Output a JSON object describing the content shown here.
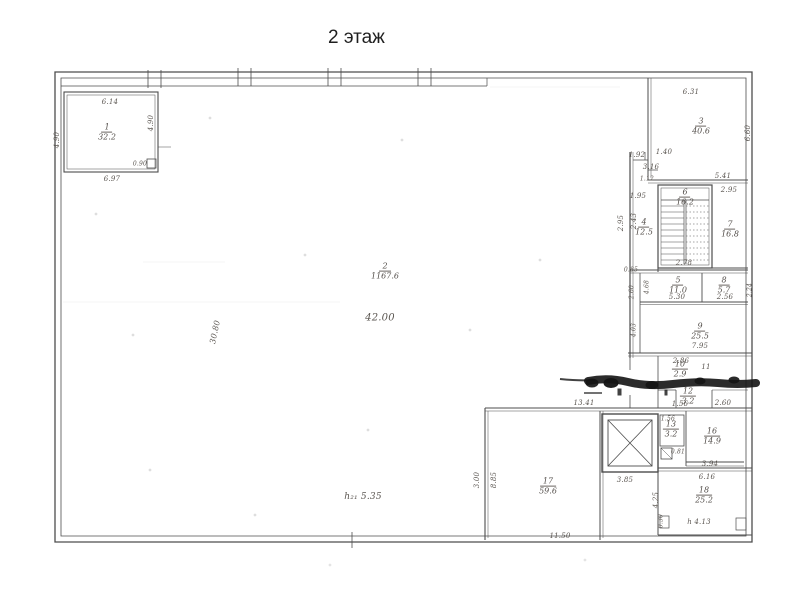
{
  "title": "2 этаж",
  "colors": {
    "paper": "#ffffff",
    "ink": "#4d4d4d",
    "pencil": "#5a5550",
    "smudge": "#141414"
  },
  "plan": {
    "rooms": [
      {
        "number": "1",
        "area": "32.2",
        "x": 107,
        "y": 133
      },
      {
        "number": "2",
        "area": "1167.6",
        "x": 385,
        "y": 272
      },
      {
        "number": "3",
        "area": "40.6",
        "x": 701,
        "y": 127
      },
      {
        "number": "4",
        "area": "12.5",
        "x": 644,
        "y": 228
      },
      {
        "number": "6",
        "area": "16.2",
        "x": 685,
        "y": 198
      },
      {
        "number": "7",
        "area": "16.8",
        "x": 730,
        "y": 230
      },
      {
        "number": "5",
        "area": "11.0",
        "x": 678,
        "y": 286
      },
      {
        "number": "8",
        "area": "5.7",
        "x": 724,
        "y": 286
      },
      {
        "number": "9",
        "area": "25.5",
        "x": 700,
        "y": 332
      },
      {
        "number": "10",
        "area": "2.9",
        "x": 680,
        "y": 370
      },
      {
        "number": "12",
        "area": "3.2",
        "x": 688,
        "y": 397
      },
      {
        "number": "13",
        "area": "3.2",
        "x": 671,
        "y": 430
      },
      {
        "number": "16",
        "area": "14.9",
        "x": 712,
        "y": 437
      },
      {
        "number": "17",
        "area": "59.6",
        "x": 548,
        "y": 487
      },
      {
        "number": "18",
        "area": "25.2",
        "x": 704,
        "y": 496
      }
    ],
    "dimensions": [
      {
        "text": "6.14",
        "x": 110,
        "y": 102
      },
      {
        "text": "6.97",
        "x": 112,
        "y": 179
      },
      {
        "text": "4.90",
        "x": 151,
        "y": 123,
        "rot": -90
      },
      {
        "text": "4.90",
        "x": 57,
        "y": 140,
        "rot": -90
      },
      {
        "text": "0.90",
        "x": 140,
        "y": 164,
        "s": 6
      },
      {
        "text": "6.31",
        "x": 691,
        "y": 92
      },
      {
        "text": "6.60",
        "x": 748,
        "y": 133,
        "rot": -90
      },
      {
        "text": "1.92",
        "x": 637,
        "y": 155
      },
      {
        "text": "1.40",
        "x": 664,
        "y": 152
      },
      {
        "text": "3.16",
        "x": 651,
        "y": 167
      },
      {
        "text": "1.12",
        "x": 647,
        "y": 179,
        "s": 6
      },
      {
        "text": "1.95",
        "x": 638,
        "y": 196
      },
      {
        "text": "5.41",
        "x": 723,
        "y": 176
      },
      {
        "text": "2.95",
        "x": 729,
        "y": 190
      },
      {
        "text": "2.95",
        "x": 621,
        "y": 223,
        "rot": -90
      },
      {
        "text": "2.43",
        "x": 634,
        "y": 221,
        "rot": -90
      },
      {
        "text": "2.78",
        "x": 684,
        "y": 263
      },
      {
        "text": "0.85",
        "x": 631,
        "y": 270,
        "s": 6
      },
      {
        "text": "2.60",
        "x": 632,
        "y": 292,
        "rot": -90,
        "s": 6
      },
      {
        "text": "4.68",
        "x": 647,
        "y": 287,
        "rot": -90,
        "s": 6
      },
      {
        "text": "5.30",
        "x": 677,
        "y": 297
      },
      {
        "text": "2.56",
        "x": 725,
        "y": 297
      },
      {
        "text": "2.24",
        "x": 750,
        "y": 290,
        "rot": -90,
        "s": 6
      },
      {
        "text": "7.95",
        "x": 700,
        "y": 346
      },
      {
        "text": "4.03",
        "x": 634,
        "y": 330,
        "rot": -90,
        "s": 6
      },
      {
        "text": "2.86",
        "x": 681,
        "y": 361
      },
      {
        "text": "11",
        "x": 706,
        "y": 367
      },
      {
        "text": "1.56",
        "x": 680,
        "y": 404
      },
      {
        "text": "2.60",
        "x": 723,
        "y": 403
      },
      {
        "text": "13.41",
        "x": 584,
        "y": 403
      },
      {
        "text": "3.85",
        "x": 625,
        "y": 480
      },
      {
        "text": "1.56",
        "x": 668,
        "y": 419,
        "s": 6
      },
      {
        "text": "0.81",
        "x": 678,
        "y": 452,
        "s": 6
      },
      {
        "text": "3.94",
        "x": 710,
        "y": 464
      },
      {
        "text": "6.16",
        "x": 707,
        "y": 477
      },
      {
        "text": "4.25",
        "x": 656,
        "y": 500,
        "rot": -90
      },
      {
        "text": "h 4.13",
        "x": 699,
        "y": 522
      },
      {
        "text": "0.30",
        "x": 661,
        "y": 521,
        "rot": -90,
        "s": 6
      },
      {
        "text": "11.50",
        "x": 560,
        "y": 536
      },
      {
        "text": "8.85",
        "x": 494,
        "y": 480,
        "rot": -90
      },
      {
        "text": "3.00",
        "x": 477,
        "y": 480,
        "rot": -90
      },
      {
        "text": "30.80",
        "x": 215,
        "y": 332,
        "rot": -78,
        "s": 8
      },
      {
        "text": "42.00",
        "x": 380,
        "y": 318,
        "s": 10
      },
      {
        "text": "h₂₁ 5.35",
        "x": 363,
        "y": 497,
        "s": 9
      }
    ]
  }
}
